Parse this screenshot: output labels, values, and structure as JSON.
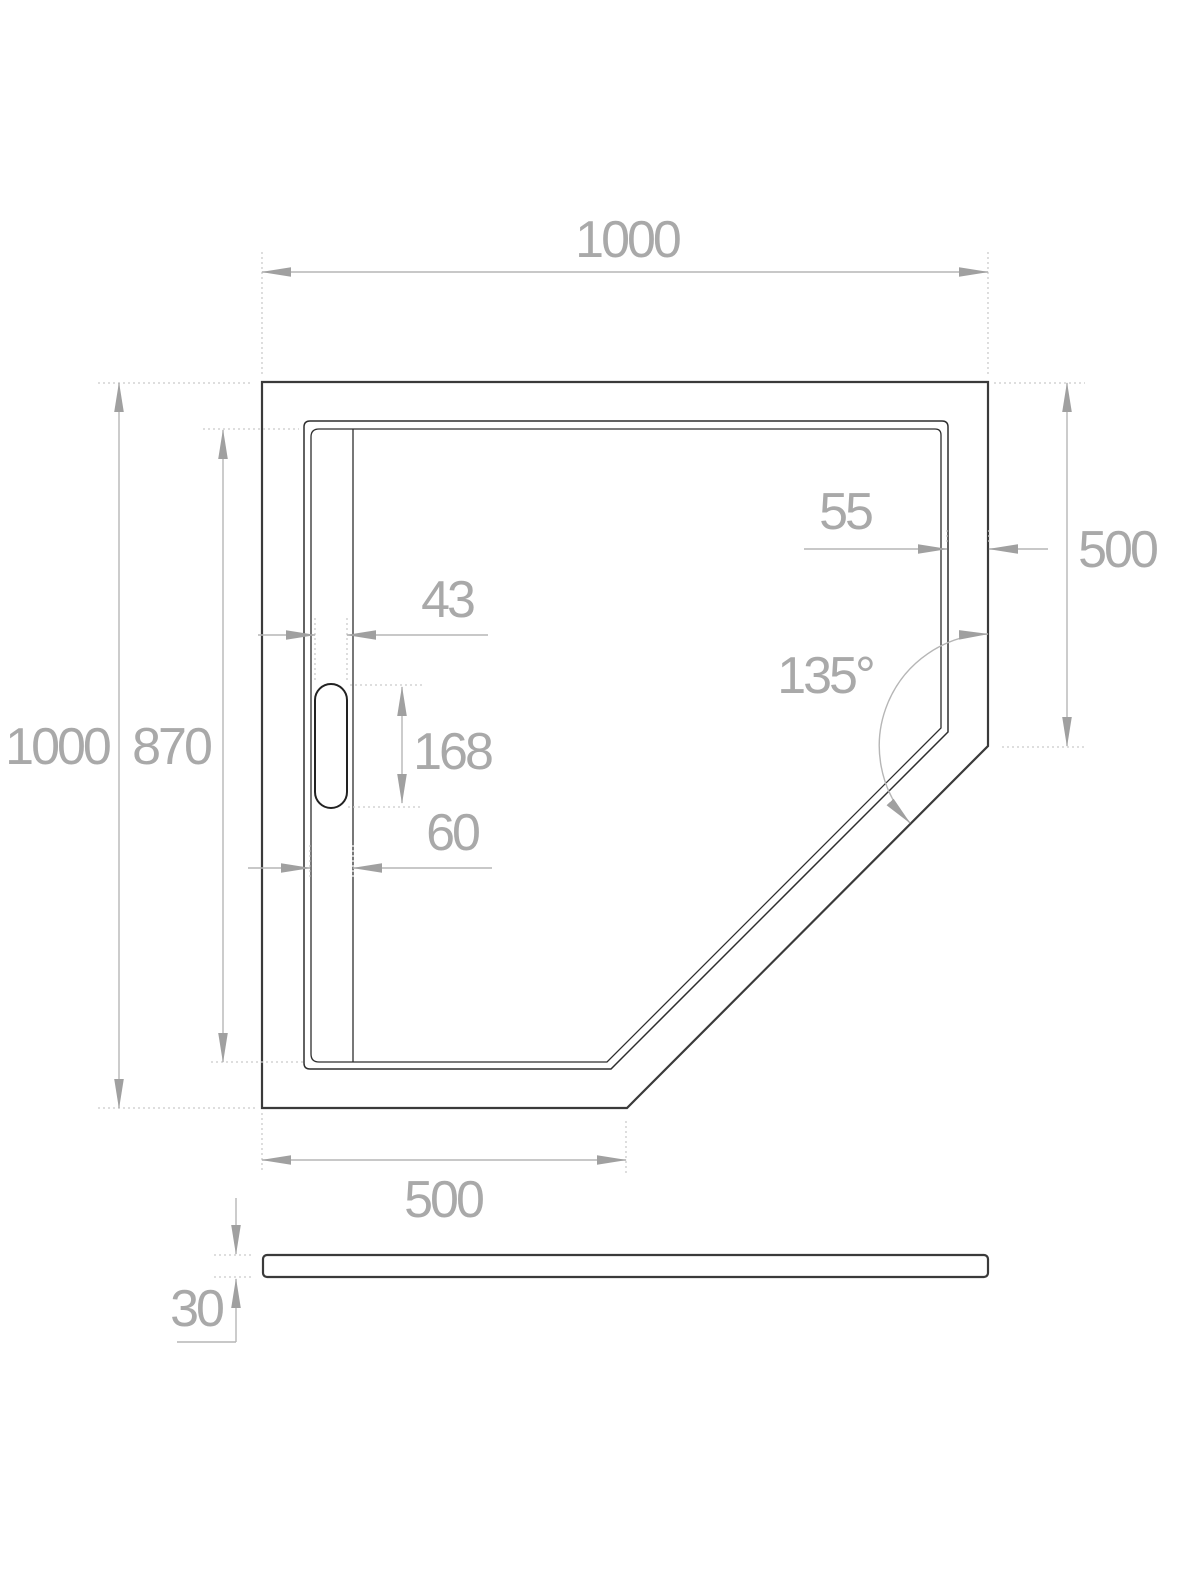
{
  "drawing": {
    "type": "technical dimension drawing",
    "subject": "pentagonal shower tray - plan view with drain channel and side profile"
  },
  "colors": {
    "background": "#ffffff",
    "outline": "#3a3a3a",
    "dimension_lines": "#b6b6b6",
    "dimension_text": "#a9a9a9",
    "extension_dotted": "#cccccc"
  },
  "dims": {
    "top_width": "1000",
    "left_depth": "1000",
    "inner_depth": "870",
    "drain_cover_width": "43",
    "drain_cover_length": "168",
    "drain_channel_width": "60",
    "right_rim_width": "55",
    "right_side_length": "500",
    "corner_angle": "135°",
    "bottom_side_length": "500",
    "thickness": "30"
  }
}
